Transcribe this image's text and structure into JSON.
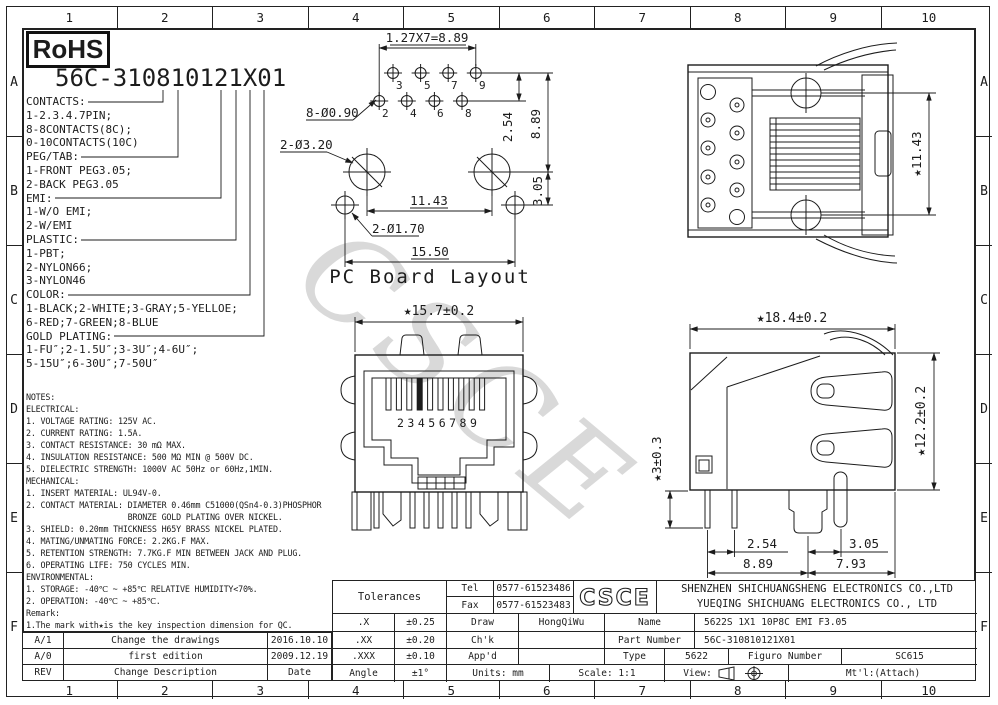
{
  "frame": {
    "columns": [
      "1",
      "2",
      "3",
      "4",
      "5",
      "6",
      "7",
      "8",
      "9",
      "10"
    ],
    "rows": [
      "A",
      "B",
      "C",
      "D",
      "E",
      "F"
    ]
  },
  "watermark": "CSCE",
  "badge": {
    "rohs": "RoHS"
  },
  "part_code": {
    "heading": "56C-310810121X01",
    "legend": [
      "CONTACTS:",
      "1-2.3.4.7PIN;",
      "8-8CONTACTS(8C);",
      "0-10CONTACTS(10C)",
      "PEG/TAB:",
      "1-FRONT PEG3.05;",
      "2-BACK PEG3.05",
      "EMI:",
      "1-W/O EMI;",
      "2-W/EMI",
      "PLASTIC:",
      "1-PBT;",
      "2-NYLON66;",
      "3-NYLON46",
      "COLOR:",
      "1-BLACK;2-WHITE;3-GRAY;5-YELLOE;",
      "6-RED;7-GREEN;8-BLUE",
      "GOLD PLATING:",
      "1-FU″;2-1.5U″;3-3U″;4-6U″;",
      "5-15U″;6-30U″;7-50U″"
    ]
  },
  "pcb_layout": {
    "title": "PC Board Layout",
    "dim_pitch": "1.27X7=8.89",
    "label_pin_holes": "8-Ø0.90",
    "label_big_holes": "2-Ø3.20",
    "label_peg_holes": "2-Ø1.70",
    "dim_row_gap": "2.54",
    "dim_rows_height": "8.89",
    "dim_peg_drop": "3.05",
    "dim_big_span": "11.43",
    "dim_total": "15.50",
    "pins_top": [
      "3",
      "5",
      "7",
      "9"
    ],
    "pins_bottom": [
      "2",
      "4",
      "6",
      "8"
    ]
  },
  "top_view": {
    "dim_height": "★11.43"
  },
  "front_view": {
    "dim_width": "★15.7±0.2",
    "pin_numbers": "23456789"
  },
  "side_view": {
    "dim_width": "★18.4±0.2",
    "dim_height": "★12.2±0.2",
    "dim_leg": "★3±0.3",
    "dim_pin_pitch": "2.54",
    "dim_pin_span": "8.89",
    "dim_peg_offset": "3.05",
    "dim_peg_span": "7.93"
  },
  "notes": {
    "lines": [
      "NOTES:",
      "ELECTRICAL:",
      "1. VOLTAGE RATING: 125V AC.",
      "2. CURRENT RATING: 1.5A.",
      "3. CONTACT RESISTANCE: 30 mΩ MAX.",
      "4. INSULATION RESISTANCE: 500 MΩ MIN @ 500V DC.",
      "5. DIELECTRIC STRENGTH: 1000V AC 50Hz or 60Hz,1MIN.",
      "MECHANICAL:",
      "1. INSERT MATERIAL: UL94V-0.",
      "2. CONTACT MATERIAL: DIAMETER 0.46mm C51000(QSn4-0.3)PHOSPHOR",
      "                     BRONZE GOLD PLATING OVER NICKEL.",
      "3. SHIELD: 0.20mm THICKNESS H65Y BRASS NICKEL PLATED.",
      "4. MATING/UNMATING FORCE: 2.2KG.F MAX.",
      "5. RETENTION STRENGTH: 7.7KG.F MIN BETWEEN JACK AND PLUG.",
      "6. OPERATING LIFE: 750 CYCLES MIN.",
      "ENVIRONMENTAL:",
      "1. STORAGE: -40℃ ~ +85℃ RELATIVE HUMIDITY<70%.",
      "2. OPERATION: -40℃ ~ +85℃.",
      "Remark:",
      "1.The mark with★is the key inspection dimension for QC."
    ]
  },
  "revisions": {
    "rows": [
      {
        "rev": "A/1",
        "desc": "Change the drawings",
        "date": "2016.10.10"
      },
      {
        "rev": "A/0",
        "desc": "first edition",
        "date": "2009.12.19"
      },
      {
        "rev": "REV",
        "desc": "Change Description",
        "date": "Date"
      }
    ]
  },
  "title_block": {
    "tolerances_label": "Tolerances",
    "tolerances": [
      {
        "label": ".X",
        "value": "±0.25"
      },
      {
        "label": ".XX",
        "value": "±0.20"
      },
      {
        "label": ".XXX",
        "value": "±0.10"
      },
      {
        "label": "Angle",
        "value": "±1°"
      }
    ],
    "tel_label": "Tel",
    "tel": "0577-61523486",
    "fax_label": "Fax",
    "fax": "0577-61523483",
    "logo": "CSCE",
    "company_line1": "SHENZHEN SHICHUANGSHENG ELECTRONICS CO.,LTD",
    "company_line2": "YUEQING SHICHUANG ELECTRONICS CO., LTD",
    "draw_label": "Draw",
    "draw": "HongQiWu",
    "chk_label": "Ch'k",
    "chk": "",
    "appd_label": "App'd",
    "appd": "",
    "name_label": "Name",
    "name": "5622S 1X1 10P8C EMI F3.05",
    "part_number_label": "Part Number",
    "part_number": "56C-310810121X01",
    "type_label": "Type",
    "type": "5622",
    "figure_number_label": "Figuro Number",
    "figure_number": "SC615",
    "units": "Units: mm",
    "scale": "Scale: 1:1",
    "view_label": "View:",
    "mtl": "Mt'l:(Attach)"
  }
}
